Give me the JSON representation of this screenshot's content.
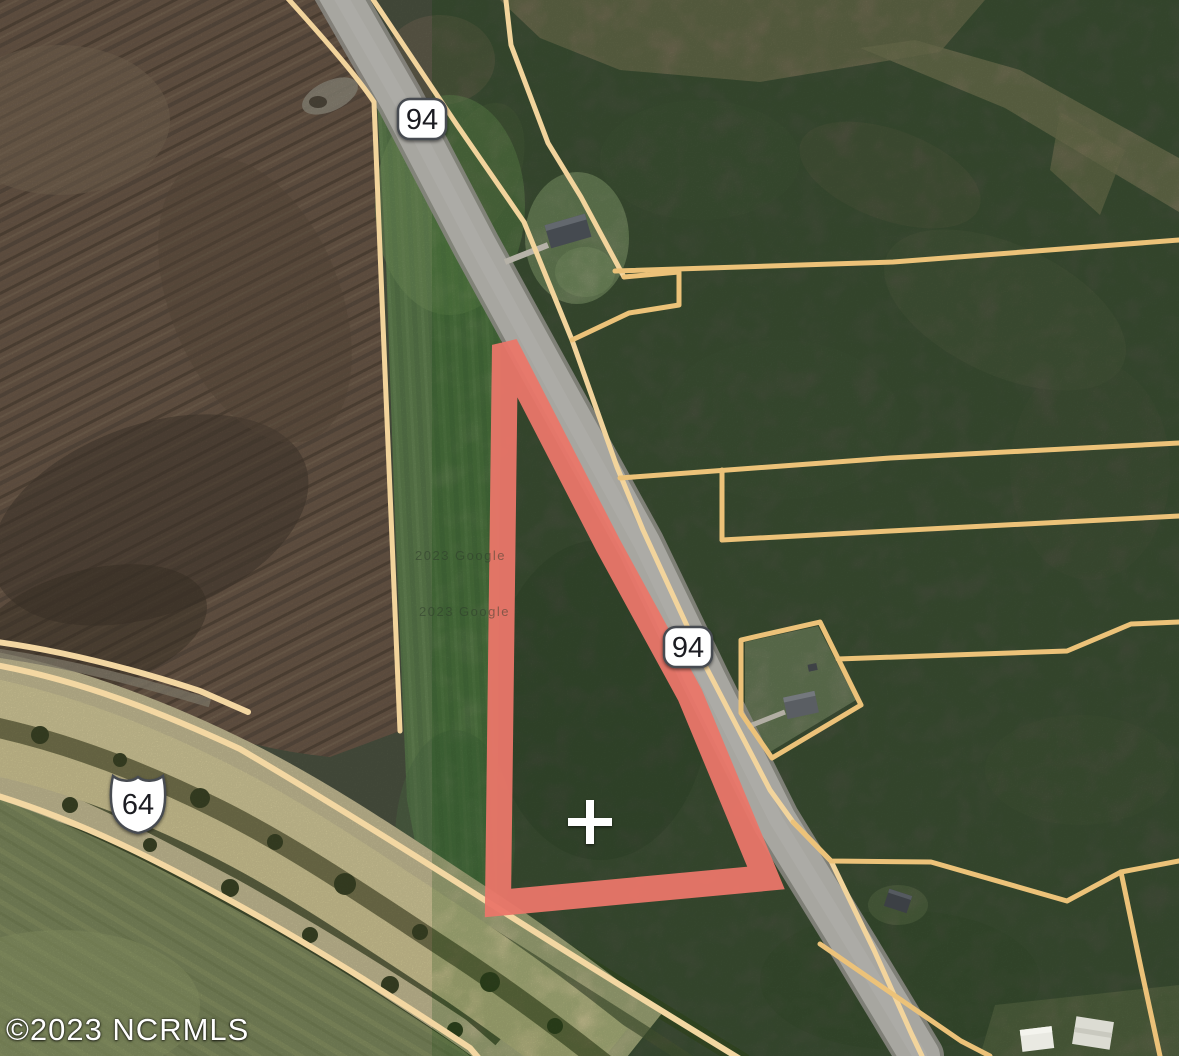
{
  "map": {
    "description": "Aerial satellite parcel map with highlighted triangular lot along NC Highway 94 near US Highway 64",
    "attribution": {
      "mls_watermark": "©2023 NCRMLS",
      "imagery_credit_1": "2023 Google",
      "imagery_credit_2": "2023 Google"
    },
    "route_shields": [
      {
        "label": "94",
        "shape": "rounded-rectangle-badge"
      },
      {
        "label": "94",
        "shape": "rounded-rectangle-badge"
      },
      {
        "label": "64",
        "shape": "us-route-shield"
      }
    ],
    "marker": {
      "type": "plus-crosshair",
      "color": "#ffffff"
    },
    "highlighted_parcel": {
      "outline_color": "#ea7669",
      "shape": "triangular-lot",
      "fill": "none"
    },
    "colors": {
      "parcel_line_gold": "#ecc279",
      "parcel_line_pale": "#f2d49c",
      "road_gray": "#a7a6a0",
      "highway_khaki": "#d7cd9c",
      "forest": "#4d5442",
      "plowed_field": "#6d5a49",
      "green_field": "#60804f"
    }
  }
}
